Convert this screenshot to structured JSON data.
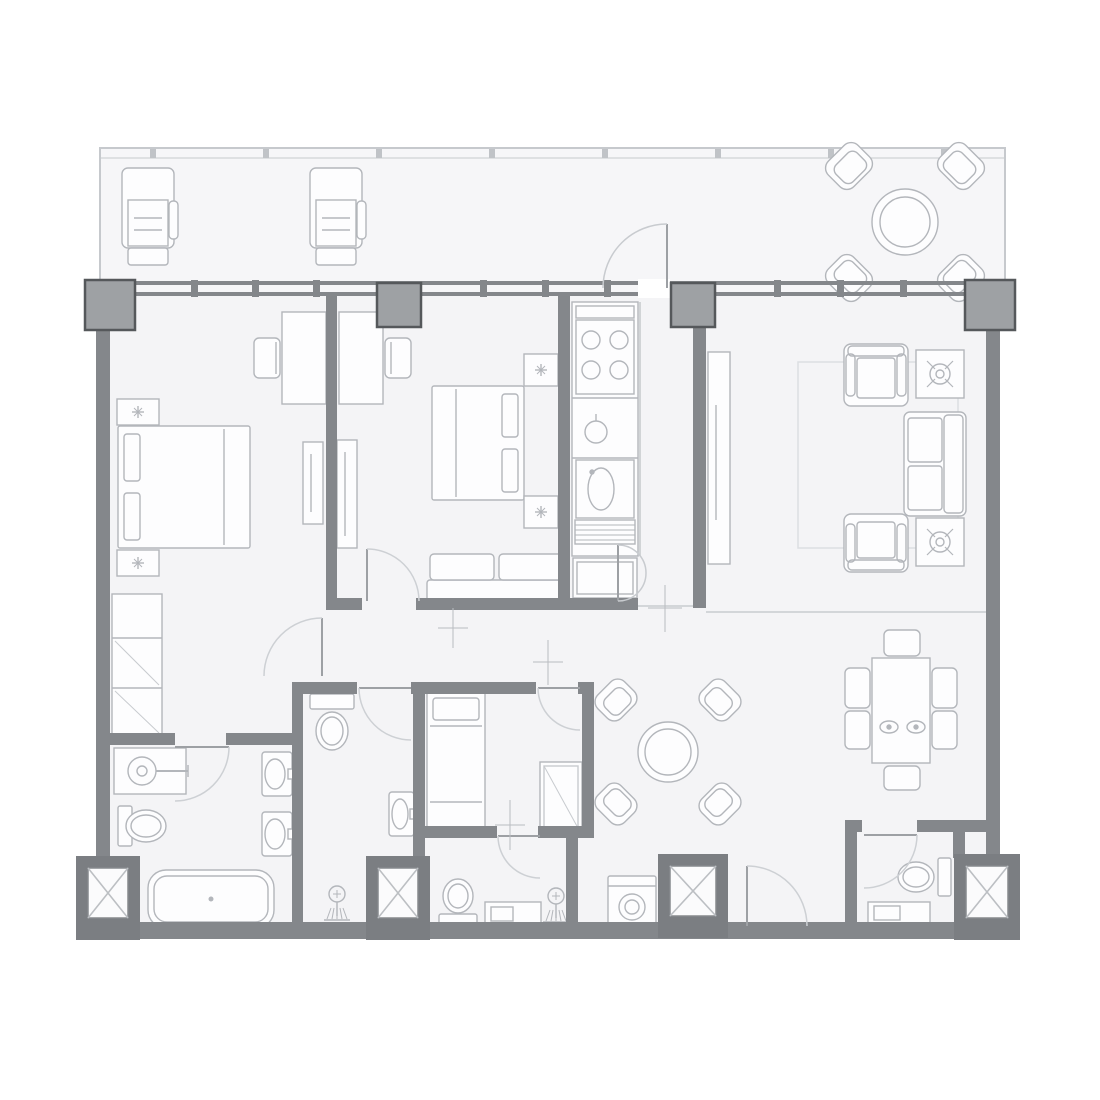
{
  "plan": {
    "canvas": {
      "w": 1100,
      "h": 1100
    },
    "colors": {
      "bg": "#ffffff",
      "floor": "#f4f4f6",
      "balconyFloor": "#f6f6f8",
      "border": "#c6c9cd",
      "wall": "#84878b",
      "column": "#9ea1a4",
      "columnStroke": "#55585b",
      "shaft": "#7b7e82",
      "shaftInner": "#fbfbfc",
      "shaftInnerStroke": "#86898d",
      "shaftX": "#bcbfc3",
      "furn": "#b3b6bb",
      "fill": "#fdfdfe",
      "door": "#cdd0d4",
      "leaf": "#9da0a4",
      "thin": "#c8cbcf",
      "mark": "#b9bcc0",
      "rug": "#dcdfe2"
    },
    "balcony": {
      "x": 100,
      "y": 148,
      "w": 905,
      "h": 148,
      "inner_line_y": 158,
      "tick_xs": [
        150,
        263,
        376,
        489,
        602,
        715,
        828,
        941
      ]
    },
    "floor": {
      "x": 96,
      "y": 292,
      "w": 904,
      "h": 646
    },
    "window_wall": {
      "x": 85,
      "w": 930,
      "y": 281,
      "bar_h": 4,
      "gap_h": 7,
      "opening": {
        "x": 638,
        "w": 32
      },
      "mullions": [
        194,
        255,
        316,
        483,
        545,
        607,
        777,
        840,
        903
      ]
    },
    "columns": [
      [
        85,
        280,
        50
      ],
      [
        377,
        283,
        44
      ],
      [
        671,
        283,
        44
      ],
      [
        965,
        280,
        50
      ]
    ],
    "walls": [
      [
        96,
        326,
        14,
        606
      ],
      [
        986,
        326,
        14,
        606
      ],
      [
        96,
        922,
        904,
        17
      ],
      [
        326,
        296,
        11,
        306
      ],
      [
        326,
        598,
        36,
        12
      ],
      [
        416,
        598,
        147,
        12
      ],
      [
        558,
        296,
        12,
        314
      ],
      [
        558,
        598,
        80,
        12
      ],
      [
        693,
        296,
        13,
        312
      ],
      [
        96,
        733,
        79,
        12
      ],
      [
        226,
        733,
        66,
        12
      ],
      [
        292,
        682,
        11,
        248
      ],
      [
        292,
        682,
        65,
        12
      ],
      [
        411,
        682,
        125,
        12
      ],
      [
        578,
        682,
        16,
        12
      ],
      [
        413,
        682,
        12,
        248
      ],
      [
        582,
        682,
        12,
        156
      ],
      [
        425,
        826,
        72,
        12
      ],
      [
        538,
        826,
        56,
        12
      ],
      [
        566,
        838,
        12,
        92
      ],
      [
        560,
        826,
        34,
        12
      ],
      [
        845,
        820,
        17,
        12
      ],
      [
        917,
        820,
        69,
        12
      ],
      [
        845,
        820,
        12,
        110
      ],
      [
        953,
        832,
        12,
        26
      ]
    ],
    "thin_lines": [
      [
        706,
        612,
        986,
        612
      ],
      [
        633,
        606,
        706,
        606
      ],
      [
        640,
        302,
        640,
        556
      ]
    ],
    "shafts": [
      [
        76,
        856,
        64,
        84
      ],
      [
        366,
        856,
        64,
        84
      ],
      [
        658,
        854,
        70,
        84
      ],
      [
        954,
        854,
        66,
        86
      ]
    ],
    "doors": [
      {
        "n": "door-bedroom-1",
        "arc": "M322,618 A58,58 0 0 0 264,676",
        "leaf": [
          322,
          618,
          322,
          676
        ]
      },
      {
        "n": "door-bedroom-2",
        "arc": "M367,549 A52,52 0 0 1 419,601",
        "leaf": [
          367,
          549,
          367,
          601
        ]
      },
      {
        "n": "door-bathroom-1",
        "arc": "M229,747 A54,54 0 0 1 175,801",
        "leaf": [
          175,
          747,
          229,
          747
        ]
      },
      {
        "n": "door-bathroom-2",
        "arc": "M359,688 A52,52 0 0 0 411,740",
        "leaf": [
          359,
          688,
          411,
          688
        ]
      },
      {
        "n": "door-bedroom-3",
        "arc": "M538,688 A42,42 0 0 0 580,730",
        "leaf": [
          538,
          688,
          580,
          688
        ]
      },
      {
        "n": "door-bathroom-3",
        "arc": "M498,836 A42,42 0 0 0 540,878",
        "leaf": [
          498,
          836,
          540,
          836
        ]
      },
      {
        "n": "door-powder-room",
        "arc": "M917,835 A53,53 0 0 1 864,888",
        "leaf": [
          864,
          835,
          917,
          835
        ]
      },
      {
        "n": "door-entrance",
        "arc": "M747,866 A60,60 0 0 1 807,926",
        "leaf": [
          747,
          866,
          747,
          926
        ]
      },
      {
        "n": "door-balcony",
        "arc": "M603,288 A64,64 0 0 1 667,224",
        "leaf": [
          667,
          224,
          667,
          288
        ],
        "light": true
      },
      {
        "n": "door-hall-fold-a",
        "arc": "M618,545 A28,28 0 0 1 646,573",
        "leaf": [
          618,
          545,
          618,
          601
        ],
        "light": true
      },
      {
        "n": "door-hall-fold-b",
        "arc": "M618,601 A28,28 0 0 0 646,573",
        "light": true
      }
    ],
    "marks": [
      [
        665,
        585,
        665,
        632,
        648,
        608,
        682,
        608
      ],
      [
        453,
        608,
        453,
        648,
        438,
        628,
        468,
        628
      ],
      [
        510,
        800,
        510,
        850,
        495,
        825,
        525,
        825
      ],
      [
        548,
        640,
        548,
        685,
        533,
        662,
        563,
        662
      ]
    ],
    "furniture": [
      {
        "t": "lounge",
        "n": "lounge-chair-1",
        "x": 122,
        "y": 168
      },
      {
        "t": "lounge",
        "n": "lounge-chair-2",
        "x": 310,
        "y": 168
      },
      {
        "t": "roundset",
        "n": "balcony-table-set",
        "cx": 905,
        "cy": 222,
        "r1": 33,
        "r2": 25,
        "dist": 56,
        "cw": 42,
        "ch": 36
      },
      {
        "t": "bed",
        "n": "bed-master",
        "x": 118,
        "y": 426,
        "w": 132,
        "h": 122,
        "head": "left"
      },
      {
        "t": "nstand",
        "n": "nightstand-1",
        "x": 117,
        "y": 399,
        "w": 42,
        "h": 26
      },
      {
        "t": "nstand",
        "n": "nightstand-2",
        "x": 117,
        "y": 550,
        "w": 42,
        "h": 26
      },
      {
        "t": "desk",
        "n": "desk-bedroom-1",
        "x": 282,
        "y": 312,
        "w": 44,
        "h": 92,
        "chair": "left"
      },
      {
        "t": "wardrobe",
        "n": "wardrobe-bedroom-1",
        "x": 303,
        "y": 442,
        "w": 20,
        "h": 82
      },
      {
        "t": "closet",
        "n": "closet-bedroom-1",
        "x": 112,
        "y": 594,
        "w": 50,
        "h": 142
      },
      {
        "t": "desk",
        "n": "desk-bedroom-2",
        "x": 339,
        "y": 312,
        "w": 44,
        "h": 92,
        "chair": "right"
      },
      {
        "t": "wardrobe",
        "n": "wardrobe-bedroom-2",
        "x": 337,
        "y": 440,
        "w": 20,
        "h": 108
      },
      {
        "t": "bed",
        "n": "bed-bedroom-2",
        "x": 432,
        "y": 386,
        "w": 92,
        "h": 114,
        "head": "right"
      },
      {
        "t": "nstand",
        "n": "nightstand-3",
        "x": 524,
        "y": 354,
        "w": 34,
        "h": 32
      },
      {
        "t": "nstand",
        "n": "nightstand-4",
        "x": 524,
        "y": 496,
        "w": 34,
        "h": 32
      },
      {
        "t": "bench",
        "n": "bench-bedroom-2",
        "x": 427,
        "y": 554,
        "w": 136,
        "h": 48
      },
      {
        "t": "kitchen",
        "n": "kitchen-unit",
        "x": 572,
        "y": 302,
        "w": 66,
        "h": 298
      },
      {
        "t": "mediaunit",
        "n": "wardrobe-living",
        "x": 708,
        "y": 352,
        "w": 22,
        "h": 212
      },
      {
        "t": "rug",
        "n": "rug-living",
        "x": 798,
        "y": 362,
        "w": 160,
        "h": 186
      },
      {
        "t": "armchair",
        "n": "armchair-1",
        "x": 844,
        "y": 344,
        "w": 64,
        "h": 62,
        "face": "down"
      },
      {
        "t": "armchair",
        "n": "armchair-2",
        "x": 844,
        "y": 514,
        "w": 64,
        "h": 58,
        "face": "up"
      },
      {
        "t": "sidetable",
        "n": "side-table-1",
        "x": 916,
        "y": 350,
        "w": 48,
        "h": 48
      },
      {
        "t": "sidetable",
        "n": "side-table-2",
        "x": 916,
        "y": 518,
        "w": 48,
        "h": 48
      },
      {
        "t": "sofa",
        "n": "sofa-living",
        "x": 904,
        "y": 412,
        "w": 62,
        "h": 104
      },
      {
        "t": "diningset",
        "n": "dining-set",
        "x": 872,
        "y": 658,
        "w": 58,
        "h": 105,
        "chairs": [
          [
            884,
            630,
            36,
            26
          ],
          [
            884,
            766,
            36,
            24
          ],
          [
            845,
            668,
            25,
            40
          ],
          [
            845,
            711,
            25,
            38
          ],
          [
            932,
            668,
            25,
            40
          ],
          [
            932,
            711,
            25,
            38
          ]
        ],
        "plates": [
          [
            889,
            727
          ],
          [
            916,
            727
          ]
        ]
      },
      {
        "t": "roundset",
        "n": "lounge-table-set",
        "cx": 668,
        "cy": 752,
        "r1": 30,
        "r2": 23,
        "dist": 52,
        "cw": 38,
        "ch": 33
      },
      {
        "t": "bed",
        "n": "bed-bedroom-3",
        "x": 427,
        "y": 692,
        "w": 58,
        "h": 140,
        "head": "top"
      },
      {
        "t": "cabinet",
        "n": "cabinet-bedroom-3",
        "x": 540,
        "y": 762,
        "w": 42,
        "h": 70
      },
      {
        "t": "toilet",
        "n": "toilet-bathroom-2",
        "tank": [
          310,
          694,
          44,
          15
        ],
        "bowl": [
          332,
          731,
          16,
          19
        ]
      },
      {
        "t": "sink",
        "n": "sink-bathroom-2",
        "x": 389,
        "y": 792,
        "w": 25,
        "h": 44,
        "basin": [
          400,
          814,
          8,
          15
        ],
        "tap": "right"
      },
      {
        "t": "shower",
        "n": "shower-bathroom-2",
        "cx": 337,
        "cy": 894
      },
      {
        "t": "toilet",
        "n": "toilet-bathroom-3",
        "tank": [
          439,
          914,
          38,
          14
        ],
        "bowl": [
          458,
          896,
          15,
          17
        ]
      },
      {
        "t": "vanity",
        "n": "vanity-bathroom-3",
        "x": 485,
        "y": 902,
        "w": 56,
        "h": 24
      },
      {
        "t": "shower",
        "n": "shower-bathroom-3",
        "cx": 556,
        "cy": 896
      },
      {
        "t": "washer",
        "n": "washing-machine",
        "x": 608,
        "y": 876,
        "w": 48,
        "h": 52
      },
      {
        "t": "toilet",
        "n": "toilet-powder-room",
        "tank": [
          938,
          858,
          13,
          38
        ],
        "bowl": [
          916,
          877,
          18,
          15
        ]
      },
      {
        "t": "shelf",
        "n": "shelf-powder-room",
        "x": 868,
        "y": 902,
        "w": 62,
        "h": 22
      },
      {
        "t": "vanity1",
        "n": "vanity-bathroom-1",
        "x": 114,
        "y": 748,
        "w": 72,
        "h": 46
      },
      {
        "t": "toilet",
        "n": "toilet-bathroom-1",
        "tank": [
          118,
          806,
          14,
          40
        ],
        "bowl": [
          146,
          826,
          20,
          16
        ]
      },
      {
        "t": "sink",
        "n": "sink-bathroom-1a",
        "x": 262,
        "y": 752,
        "w": 30,
        "h": 44,
        "basin": [
          275,
          774,
          10,
          15
        ],
        "tap": "right"
      },
      {
        "t": "sink",
        "n": "sink-bathroom-1b",
        "x": 262,
        "y": 812,
        "w": 30,
        "h": 44,
        "basin": [
          275,
          834,
          10,
          15
        ],
        "tap": "right"
      },
      {
        "t": "bathtub",
        "n": "bathtub-bathroom-1",
        "x": 148,
        "y": 870,
        "w": 126,
        "h": 58
      }
    ]
  }
}
